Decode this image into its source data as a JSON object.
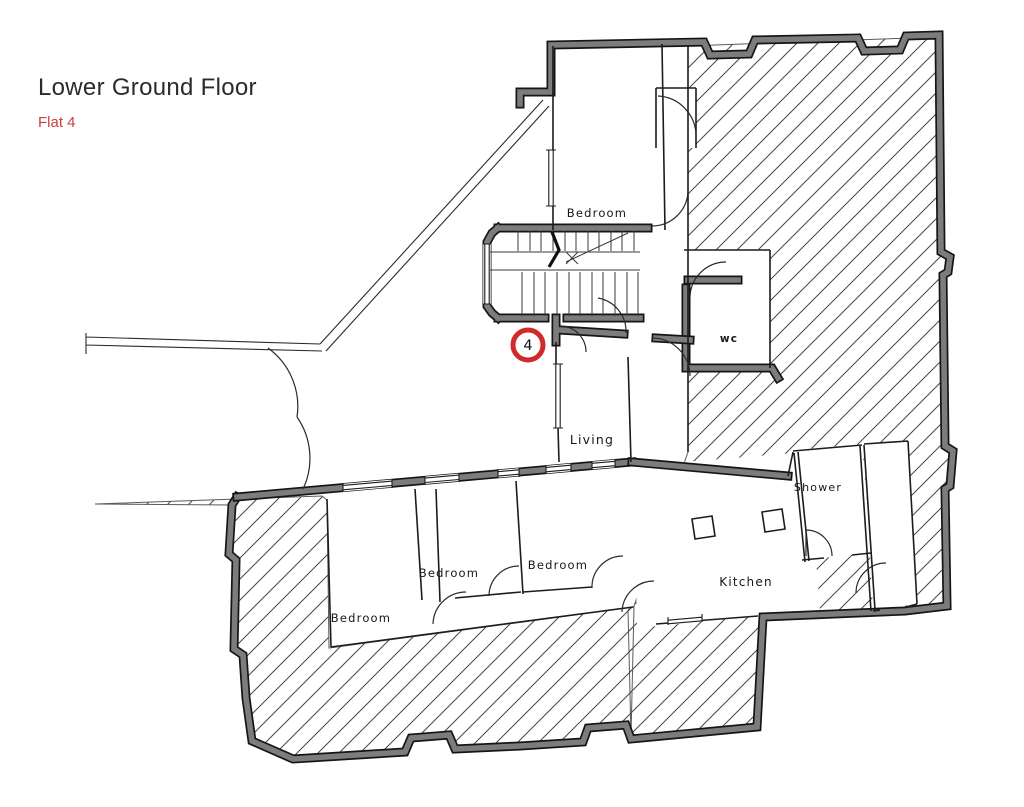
{
  "header": {
    "title": "Lower Ground Floor",
    "subtitle": "Flat 4"
  },
  "marker": {
    "number": "4"
  },
  "rooms": {
    "bedroom_top": {
      "label": "Bedroom"
    },
    "wc": {
      "label": "wc"
    },
    "living": {
      "label": "Living"
    },
    "shower": {
      "label": "Shower"
    },
    "kitchen": {
      "label": "Kitchen"
    },
    "bedroom_mid_left": {
      "label": "Bedroom"
    },
    "bedroom_mid_right": {
      "label": "Bedroom"
    },
    "bedroom_large": {
      "label": "Bedroom"
    }
  },
  "colors": {
    "accent_red": "#cf2b2b",
    "wall_gray": "#7c7c7c",
    "wall_edge": "#151515",
    "title_text": "#2b2b2b",
    "subtitle_red": "#c64040",
    "hatch_line": "#4a4a4a"
  }
}
